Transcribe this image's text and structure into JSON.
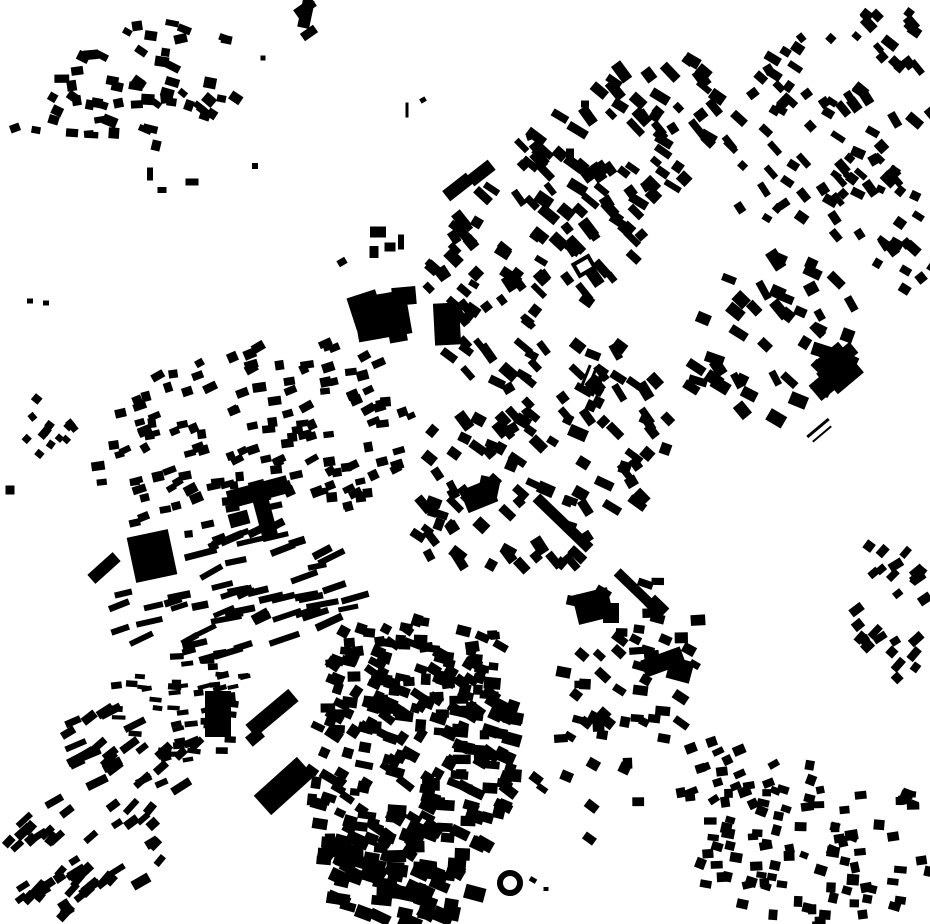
{
  "canvas": {
    "width": 930,
    "height": 924
  },
  "colors": {
    "background": "#ffffff",
    "building": "#000000"
  },
  "map": {
    "kind": "figure-ground-building-footprints",
    "landmarks": [
      {
        "name": "factory-main-a",
        "rect": [
          382,
          316,
          54,
          44,
          -10
        ]
      },
      {
        "name": "factory-main-b",
        "rect": [
          366,
          310,
          30,
          34,
          -18
        ]
      },
      {
        "name": "factory-main-c",
        "rect": [
          404,
          296,
          24,
          18,
          -5
        ]
      },
      {
        "name": "factory-main-d",
        "rect": [
          398,
          336,
          18,
          12,
          -10
        ]
      },
      {
        "name": "factory-annex",
        "rect": [
          447,
          324,
          26,
          42,
          -3
        ]
      },
      {
        "name": "north-slab-a",
        "rect": [
          458,
          187,
          30,
          13,
          -38
        ]
      },
      {
        "name": "north-slab-b",
        "rect": [
          481,
          173,
          27,
          13,
          -38
        ]
      },
      {
        "name": "center-church-a",
        "rect": [
          479,
          496,
          32,
          24,
          -22
        ]
      },
      {
        "name": "center-church-b",
        "rect": [
          489,
          487,
          20,
          20,
          12
        ]
      },
      {
        "name": "station-slab",
        "rect": [
          563,
          523,
          74,
          11,
          44
        ]
      },
      {
        "name": "station-slab-south",
        "rect": [
          638,
          592,
          58,
          10,
          44
        ]
      },
      {
        "name": "station-slab-blob",
        "rect": [
          657,
          607,
          20,
          15,
          44
        ]
      },
      {
        "name": "center-hall-a",
        "rect": [
          663,
          662,
          42,
          18,
          -20
        ]
      },
      {
        "name": "center-hall-b",
        "rect": [
          680,
          670,
          24,
          22,
          15
        ]
      },
      {
        "name": "school-block-a",
        "rect": [
          593,
          606,
          36,
          30,
          -14
        ]
      },
      {
        "name": "school-block-b",
        "rect": [
          611,
          613,
          16,
          20,
          0
        ]
      },
      {
        "name": "west-big-block",
        "rect": [
          152,
          556,
          42,
          46,
          -12
        ]
      },
      {
        "name": "west-cross-a",
        "rect": [
          258,
          492,
          62,
          18,
          -15
        ]
      },
      {
        "name": "west-cross-b",
        "rect": [
          263,
          509,
          16,
          58,
          -15
        ]
      },
      {
        "name": "west-cross-c",
        "rect": [
          239,
          519,
          20,
          14,
          -15
        ]
      },
      {
        "name": "west-slab",
        "rect": [
          104,
          568,
          34,
          12,
          -42
        ]
      },
      {
        "name": "sw-diagonal-slab",
        "rect": [
          272,
          713,
          56,
          16,
          -40
        ]
      },
      {
        "name": "sw-parallelogram",
        "rect": [
          284,
          786,
          58,
          26,
          -42
        ]
      },
      {
        "name": "sw-vertical-bar",
        "rect": [
          218,
          714,
          26,
          46,
          0
        ]
      },
      {
        "name": "sw-extra-block",
        "rect": [
          255,
          737,
          16,
          12,
          -40
        ]
      },
      {
        "name": "east-complex-a",
        "rect": [
          838,
          368,
          34,
          40,
          -40
        ]
      },
      {
        "name": "east-complex-b",
        "rect": [
          825,
          385,
          26,
          20,
          -40
        ]
      },
      {
        "name": "east-complex-c",
        "rect": [
          847,
          353,
          18,
          14,
          -40
        ]
      },
      {
        "name": "y-building-a",
        "rect": [
          306,
          14,
          12,
          28,
          12
        ]
      },
      {
        "name": "y-building-b",
        "rect": [
          305,
          8,
          22,
          10,
          -35
        ]
      },
      {
        "name": "y-building-c",
        "rect": [
          309,
          33,
          16,
          9,
          -35
        ]
      }
    ],
    "singles": [
      [
        15,
        128,
        10,
        8,
        -20
      ],
      [
        36,
        130,
        9,
        7,
        10
      ],
      [
        30,
        301,
        6,
        5,
        0
      ],
      [
        46,
        303,
        6,
        5,
        0
      ],
      [
        150,
        174,
        6,
        13,
        0
      ],
      [
        162,
        190,
        9,
        6,
        0
      ],
      [
        192,
        182,
        13,
        7,
        0
      ],
      [
        255,
        166,
        6,
        6,
        0
      ],
      [
        263,
        58,
        5,
        5,
        0
      ],
      [
        378,
        232,
        16,
        11,
        0
      ],
      [
        390,
        247,
        11,
        9,
        0
      ],
      [
        374,
        252,
        9,
        12,
        0
      ],
      [
        401,
        242,
        6,
        15,
        0
      ],
      [
        342,
        262,
        9,
        7,
        -30
      ],
      [
        407,
        110,
        3,
        15,
        0
      ],
      [
        423,
        100,
        6,
        5,
        -30
      ],
      [
        530,
        137,
        7,
        6,
        -20
      ],
      [
        585,
        104,
        8,
        7,
        0
      ],
      [
        570,
        153,
        8,
        9,
        0
      ],
      [
        10,
        490,
        9,
        9,
        0
      ],
      [
        585,
        378,
        3,
        28,
        22
      ],
      [
        591,
        381,
        3,
        28,
        22
      ],
      [
        597,
        384,
        3,
        26,
        22
      ],
      [
        818,
        428,
        28,
        3,
        -40
      ],
      [
        822,
        434,
        24,
        2,
        -40
      ],
      [
        533,
        880,
        7,
        5,
        30
      ],
      [
        546,
        889,
        5,
        4,
        0
      ]
    ],
    "hollow_circles": [
      {
        "name": "ring-building",
        "cx": 510,
        "cy": 883,
        "r": 10,
        "stroke": 6
      }
    ],
    "hollow_rects": [
      {
        "name": "courtyard-building",
        "rect": [
          584,
          266,
          17,
          13,
          -30
        ],
        "stroke": 4
      }
    ],
    "clusters": [
      {
        "name": "village-northwest",
        "seed": 11,
        "cx": 145,
        "cy": 85,
        "rx": 100,
        "ry": 62,
        "tilt": -12,
        "count": 58,
        "angle": 15,
        "jitter": 28,
        "wMin": 8,
        "wMax": 15,
        "hMin": 6,
        "hMax": 11
      },
      {
        "name": "west-diamond-hamlet",
        "seed": 12,
        "cx": 48,
        "cy": 421,
        "rx": 27,
        "ry": 37,
        "tilt": 0,
        "count": 13,
        "angle": 45,
        "jitter": 10,
        "wMin": 7,
        "wMax": 9,
        "hMin": 6,
        "hMax": 8
      },
      {
        "name": "northeast-corridor",
        "seed": 13,
        "cx": 566,
        "cy": 214,
        "rx": 208,
        "ry": 80,
        "tilt": -47,
        "count": 150,
        "angle": 44,
        "jitter": 14,
        "wMin": 9,
        "wMax": 21,
        "hMin": 6,
        "hMax": 12
      },
      {
        "name": "far-northeast",
        "seed": 14,
        "cx": 845,
        "cy": 108,
        "rx": 148,
        "ry": 92,
        "tilt": -40,
        "count": 80,
        "angle": 44,
        "jitter": 16,
        "wMin": 8,
        "wMax": 17,
        "hMin": 6,
        "hMax": 11
      },
      {
        "name": "east-upper",
        "seed": 15,
        "cx": 886,
        "cy": 225,
        "rx": 58,
        "ry": 78,
        "tilt": -20,
        "count": 28,
        "angle": 40,
        "jitter": 18,
        "wMin": 8,
        "wMax": 15,
        "hMin": 6,
        "hMax": 10
      },
      {
        "name": "east-villas",
        "seed": 16,
        "cx": 770,
        "cy": 340,
        "rx": 92,
        "ry": 78,
        "tilt": -30,
        "count": 46,
        "angle": 40,
        "jitter": 24,
        "wMin": 10,
        "wMax": 21,
        "hMin": 7,
        "hMax": 13
      },
      {
        "name": "city-center",
        "seed": 17,
        "cx": 540,
        "cy": 462,
        "rx": 150,
        "ry": 104,
        "tilt": -35,
        "count": 118,
        "angle": 40,
        "jitter": 22,
        "wMin": 9,
        "wMax": 19,
        "hMin": 7,
        "hMax": 12
      },
      {
        "name": "west-grid",
        "seed": 18,
        "cx": 255,
        "cy": 443,
        "rx": 163,
        "ry": 100,
        "tilt": -12,
        "count": 148,
        "angle": -18,
        "jitter": 13,
        "wMin": 8,
        "wMax": 14,
        "hMin": 6,
        "hMax": 10
      },
      {
        "name": "row-housing-west",
        "seed": 19,
        "cx": 235,
        "cy": 593,
        "rx": 132,
        "ry": 62,
        "tilt": -8,
        "count": 55,
        "angle": -20,
        "jitter": 10,
        "wMin": 16,
        "wMax": 33,
        "hMin": 5,
        "hMax": 8
      },
      {
        "name": "terrace-combs",
        "seed": 20,
        "cx": 180,
        "cy": 700,
        "rx": 74,
        "ry": 60,
        "tilt": 10,
        "count": 52,
        "angle": -5,
        "jitter": 14,
        "wMin": 9,
        "wMax": 14,
        "hMin": 4,
        "hMax": 7
      },
      {
        "name": "southwest-lower",
        "seed": 21,
        "cx": 133,
        "cy": 753,
        "rx": 74,
        "ry": 44,
        "tilt": 15,
        "count": 28,
        "angle": -30,
        "jitter": 14,
        "wMin": 12,
        "wMax": 23,
        "hMin": 6,
        "hMax": 9
      },
      {
        "name": "old-town-upper",
        "seed": 22,
        "cx": 420,
        "cy": 664,
        "rx": 95,
        "ry": 54,
        "tilt": 5,
        "count": 68,
        "angle": 15,
        "jitter": 24,
        "wMin": 9,
        "wMax": 16,
        "hMin": 7,
        "hMax": 12
      },
      {
        "name": "old-town-core",
        "seed": 23,
        "cx": 413,
        "cy": 764,
        "rx": 103,
        "ry": 132,
        "tilt": 20,
        "count": 205,
        "angle": 18,
        "jitter": 20,
        "wMin": 9,
        "wMax": 19,
        "hMin": 7,
        "hMax": 13
      },
      {
        "name": "old-town-south",
        "seed": 24,
        "cx": 396,
        "cy": 868,
        "rx": 84,
        "ry": 54,
        "tilt": 10,
        "count": 52,
        "angle": 15,
        "jitter": 17,
        "wMin": 12,
        "wMax": 24,
        "hMin": 8,
        "hMax": 15
      },
      {
        "name": "east-band",
        "seed": 25,
        "cx": 625,
        "cy": 668,
        "rx": 80,
        "ry": 103,
        "tilt": 15,
        "count": 52,
        "angle": 20,
        "jitter": 26,
        "wMin": 9,
        "wMax": 16,
        "hMin": 7,
        "hMax": 11
      },
      {
        "name": "east-band-south",
        "seed": 26,
        "cx": 592,
        "cy": 792,
        "rx": 58,
        "ry": 56,
        "tilt": 0,
        "count": 6,
        "angle": 20,
        "jitter": 24,
        "wMin": 8,
        "wMax": 14,
        "hMin": 6,
        "hMax": 10
      },
      {
        "name": "southwest-corner",
        "seed": 27,
        "cx": 85,
        "cy": 853,
        "rx": 88,
        "ry": 60,
        "tilt": -10,
        "count": 54,
        "angle": -40,
        "jitter": 11,
        "wMin": 10,
        "wMax": 19,
        "hMin": 6,
        "hMax": 10
      },
      {
        "name": "southeast-main",
        "seed": 28,
        "cx": 815,
        "cy": 845,
        "rx": 122,
        "ry": 88,
        "tilt": 0,
        "count": 95,
        "angle": 5,
        "jitter": 18,
        "wMin": 8,
        "wMax": 13,
        "hMin": 6,
        "hMax": 11
      },
      {
        "name": "southeast-arm",
        "seed": 29,
        "cx": 725,
        "cy": 773,
        "rx": 58,
        "ry": 43,
        "tilt": -20,
        "count": 20,
        "angle": -20,
        "jitter": 14,
        "wMin": 9,
        "wMax": 13,
        "hMin": 6,
        "hMax": 10
      },
      {
        "name": "east-edge-mid",
        "seed": 30,
        "cx": 895,
        "cy": 610,
        "rx": 42,
        "ry": 74,
        "tilt": -15,
        "count": 27,
        "angle": -40,
        "jitter": 14,
        "wMin": 9,
        "wMax": 15,
        "hMin": 6,
        "hMax": 10
      }
    ]
  }
}
